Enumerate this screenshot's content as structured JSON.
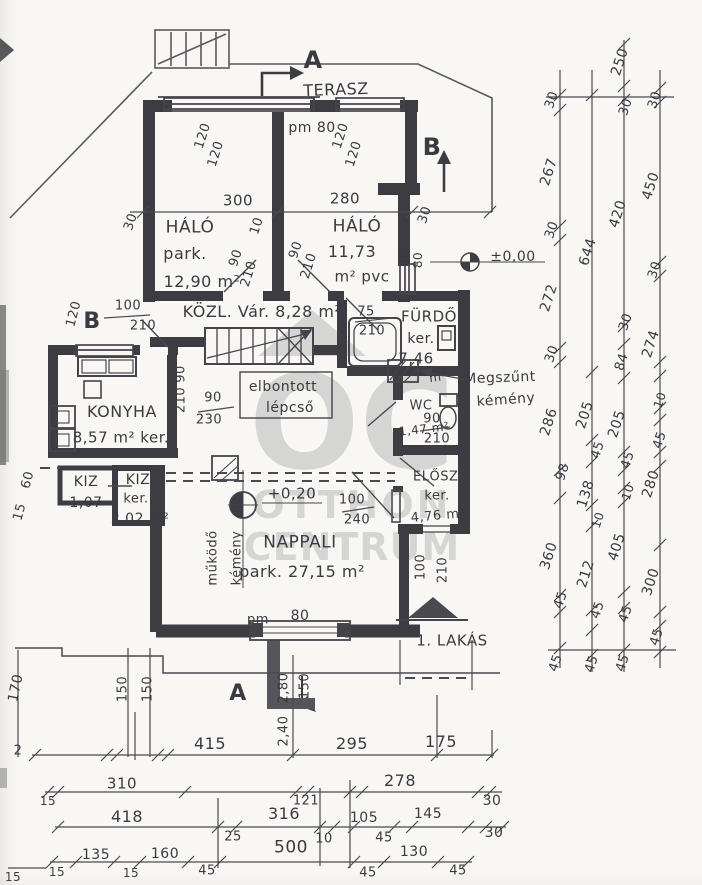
{
  "watermark": {
    "monogram": "OC",
    "line1": "OTTHON",
    "line2": "CENTRUM",
    "color": "#b4b4b4"
  },
  "plan": {
    "apartment_label": "1. LAKÁS",
    "rooms": [
      {
        "name": "TERASZ"
      },
      {
        "name": "HÁLÓ",
        "floor": "park.",
        "area": "12,90 m²"
      },
      {
        "name": "HÁLÓ",
        "area": "11,73",
        "floor": "m² pvc"
      },
      {
        "name": "KÖZL.",
        "note": "Vár.",
        "area": "8,28 m²"
      },
      {
        "name": "FÜRDŐ",
        "floor": "ker.",
        "area": "7,46 m²"
      },
      {
        "name": "KONYHA",
        "area": "8,57 m²",
        "floor": "ker."
      },
      {
        "name": "WC",
        "area": "1,47 m²"
      },
      {
        "name": "KIZ",
        "area": "1,07"
      },
      {
        "name": "KIZ",
        "floor": "ker.",
        "area": "2,02 m²"
      },
      {
        "name": "ELŐSZ.",
        "floor": "ker.",
        "area": "4,76 m²"
      },
      {
        "name": "NAPPALI",
        "floor": "park.",
        "area": "27,15 m²"
      }
    ],
    "notes": [
      "elbontott lépcső",
      "Megszűnt kémény",
      "működő kémény"
    ],
    "levels": [
      "±0,00",
      "+0,20"
    ],
    "section_markers": [
      "A",
      "B"
    ]
  },
  "labels": [
    {
      "t": "TERASZ",
      "x": 336,
      "y": 90,
      "s": 16,
      "r": -2,
      "n": "room-label-terasz"
    },
    {
      "t": "A",
      "x": 313,
      "y": 60,
      "s": 24,
      "b": 1,
      "n": "section-marker-a-top"
    },
    {
      "t": "pm 80",
      "x": 312,
      "y": 128,
      "s": 14
    },
    {
      "t": "120",
      "x": 203,
      "y": 136,
      "r": -72,
      "s": 13
    },
    {
      "t": "120",
      "x": 216,
      "y": 154,
      "r": -72,
      "s": 13
    },
    {
      "t": "120",
      "x": 341,
      "y": 136,
      "r": -72,
      "s": 13
    },
    {
      "t": "120",
      "x": 354,
      "y": 154,
      "r": -72,
      "s": 13
    },
    {
      "t": "B",
      "x": 432,
      "y": 147,
      "s": 24,
      "b": 1,
      "n": "section-marker-b-top"
    },
    {
      "t": "300",
      "x": 238,
      "y": 201,
      "s": 15
    },
    {
      "t": "280",
      "x": 345,
      "y": 199,
      "s": 15
    },
    {
      "t": "30",
      "x": 131,
      "y": 222,
      "r": -72,
      "s": 13
    },
    {
      "t": "10",
      "x": 257,
      "y": 226,
      "r": -72,
      "s": 13
    },
    {
      "t": "30",
      "x": 425,
      "y": 215,
      "r": -72,
      "s": 13
    },
    {
      "t": "HÁLÓ",
      "x": 190,
      "y": 228,
      "s": 17,
      "n": "room-label-halo-1"
    },
    {
      "t": "park.",
      "x": 185,
      "y": 254,
      "s": 16
    },
    {
      "t": "12,90 m²",
      "x": 202,
      "y": 282,
      "s": 16
    },
    {
      "t": "HÁLÓ",
      "x": 357,
      "y": 227,
      "s": 17,
      "n": "room-label-halo-2"
    },
    {
      "t": "11,73",
      "x": 352,
      "y": 252,
      "s": 16
    },
    {
      "t": "m² pvc",
      "x": 362,
      "y": 277,
      "s": 15
    },
    {
      "t": "90",
      "x": 236,
      "y": 258,
      "r": -72,
      "s": 13
    },
    {
      "t": "210",
      "x": 249,
      "y": 274,
      "r": -72,
      "s": 13
    },
    {
      "t": "90",
      "x": 296,
      "y": 250,
      "r": -72,
      "s": 13
    },
    {
      "t": "210",
      "x": 309,
      "y": 266,
      "r": -72,
      "s": 13
    },
    {
      "t": "60",
      "x": 404,
      "y": 258,
      "r": -90,
      "s": 12
    },
    {
      "t": "80",
      "x": 418,
      "y": 260,
      "r": -90,
      "s": 12
    },
    {
      "t": "±0,00",
      "x": 513,
      "y": 257,
      "s": 14,
      "n": "level-marker-zero"
    },
    {
      "t": "B",
      "x": 92,
      "y": 322,
      "s": 22,
      "b": 1,
      "n": "section-marker-b-left"
    },
    {
      "t": "120",
      "x": 74,
      "y": 314,
      "r": -75,
      "s": 13
    },
    {
      "t": "100",
      "x": 128,
      "y": 306,
      "s": 13
    },
    {
      "t": "210",
      "x": 143,
      "y": 326,
      "s": 13
    },
    {
      "t": "KÖZL. Vár. 8,28 m²",
      "x": 262,
      "y": 312,
      "s": 16,
      "n": "room-label-kozl"
    },
    {
      "t": "75",
      "x": 366,
      "y": 312,
      "s": 13
    },
    {
      "t": "210",
      "x": 372,
      "y": 331,
      "s": 13
    },
    {
      "t": "FÜRDŐ",
      "x": 429,
      "y": 317,
      "s": 15,
      "n": "room-label-furdo"
    },
    {
      "t": "ker.",
      "x": 421,
      "y": 339,
      "s": 14
    },
    {
      "t": "7,46",
      "x": 416,
      "y": 359,
      "s": 15
    },
    {
      "t": "m²",
      "x": 438,
      "y": 377,
      "s": 12,
      "r": -8
    },
    {
      "t": "Megszűnt",
      "x": 500,
      "y": 378,
      "s": 14,
      "r": -2,
      "n": "note-megszunt-kemeny"
    },
    {
      "t": "kémény",
      "x": 506,
      "y": 400,
      "s": 14,
      "r": -4
    },
    {
      "t": "90",
      "x": 181,
      "y": 374,
      "r": -90,
      "s": 13
    },
    {
      "t": "210",
      "x": 181,
      "y": 400,
      "r": -90,
      "s": 13
    },
    {
      "t": "elbontott",
      "x": 283,
      "y": 387,
      "s": 14,
      "n": "note-elbontott-lepcso"
    },
    {
      "t": "lépcső",
      "x": 290,
      "y": 408,
      "s": 14
    },
    {
      "t": "90",
      "x": 213,
      "y": 398,
      "s": 13
    },
    {
      "t": "230",
      "x": 209,
      "y": 420,
      "s": 13
    },
    {
      "t": "KONYHA",
      "x": 122,
      "y": 412,
      "s": 16,
      "n": "room-label-konyha"
    },
    {
      "t": "8,57 m² ker.",
      "x": 121,
      "y": 438,
      "s": 15
    },
    {
      "t": "WC",
      "x": 421,
      "y": 406,
      "s": 13,
      "n": "room-label-wc"
    },
    {
      "t": "1,47 m²",
      "x": 424,
      "y": 429,
      "s": 12,
      "r": -6
    },
    {
      "t": "90",
      "x": 432,
      "y": 419,
      "s": 13
    },
    {
      "t": "210",
      "x": 437,
      "y": 439,
      "s": 13
    },
    {
      "t": "60",
      "x": 28,
      "y": 480,
      "r": -75,
      "s": 13
    },
    {
      "t": "15",
      "x": 20,
      "y": 512,
      "r": -75,
      "s": 13
    },
    {
      "t": "KIZ",
      "x": 86,
      "y": 482,
      "s": 14,
      "n": "room-label-kiz-1"
    },
    {
      "t": "1,07",
      "x": 86,
      "y": 503,
      "s": 14
    },
    {
      "t": "KIZ",
      "x": 138,
      "y": 480,
      "s": 14,
      "n": "room-label-kiz-2"
    },
    {
      "t": "ker.",
      "x": 136,
      "y": 499,
      "s": 13
    },
    {
      "t": "2,02 m²",
      "x": 140,
      "y": 519,
      "s": 14
    },
    {
      "t": "ELŐSZ.",
      "x": 438,
      "y": 477,
      "s": 13,
      "n": "room-label-elosz"
    },
    {
      "t": "ker.",
      "x": 437,
      "y": 496,
      "s": 13
    },
    {
      "t": "4,76 m²",
      "x": 438,
      "y": 516,
      "s": 13,
      "r": -5
    },
    {
      "t": "+0,20",
      "x": 292,
      "y": 494,
      "s": 15,
      "n": "level-marker-plus020"
    },
    {
      "t": "100",
      "x": 352,
      "y": 500,
      "s": 13
    },
    {
      "t": "240",
      "x": 357,
      "y": 520,
      "s": 13
    },
    {
      "t": "NAPPALI",
      "x": 300,
      "y": 543,
      "s": 17,
      "n": "room-label-nappali"
    },
    {
      "t": "park. 27,15 m²",
      "x": 302,
      "y": 572,
      "s": 16
    },
    {
      "t": "működő",
      "x": 213,
      "y": 558,
      "r": -90,
      "s": 13,
      "n": "note-mukodo-kemeny"
    },
    {
      "t": "kémény",
      "x": 237,
      "y": 558,
      "r": -90,
      "s": 13
    },
    {
      "t": "100",
      "x": 421,
      "y": 567,
      "r": -90,
      "s": 13
    },
    {
      "t": "210",
      "x": 443,
      "y": 570,
      "r": -90,
      "s": 13
    },
    {
      "t": "1. LAKÁS",
      "x": 452,
      "y": 641,
      "s": 15,
      "n": "apartment-label"
    },
    {
      "t": "pm",
      "x": 258,
      "y": 620,
      "s": 13
    },
    {
      "t": "80",
      "x": 300,
      "y": 616,
      "s": 14
    },
    {
      "t": "A",
      "x": 238,
      "y": 694,
      "s": 22,
      "b": 1,
      "n": "section-marker-a-bottom"
    },
    {
      "t": "2,80",
      "x": 284,
      "y": 688,
      "r": -90,
      "s": 13
    },
    {
      "t": "150",
      "x": 305,
      "y": 686,
      "r": -90,
      "s": 13
    },
    {
      "t": "2,40",
      "x": 284,
      "y": 731,
      "r": -90,
      "s": 13
    },
    {
      "t": "170",
      "x": 16,
      "y": 688,
      "r": -78,
      "s": 14
    },
    {
      "t": "150",
      "x": 123,
      "y": 689,
      "r": -90,
      "s": 13
    },
    {
      "t": "150",
      "x": 148,
      "y": 689,
      "r": -90,
      "s": 13
    },
    {
      "t": "2",
      "x": 18,
      "y": 751,
      "s": 13
    },
    {
      "t": "415",
      "x": 210,
      "y": 744,
      "s": 16
    },
    {
      "t": "295",
      "x": 352,
      "y": 744,
      "s": 16
    },
    {
      "t": "175",
      "x": 441,
      "y": 742,
      "s": 16
    },
    {
      "t": "15",
      "x": 48,
      "y": 801,
      "s": 12
    },
    {
      "t": "310",
      "x": 122,
      "y": 784,
      "s": 15
    },
    {
      "t": "121",
      "x": 306,
      "y": 801,
      "s": 13
    },
    {
      "t": "278",
      "x": 400,
      "y": 781,
      "s": 16
    },
    {
      "t": "30",
      "x": 492,
      "y": 801,
      "s": 14
    },
    {
      "t": "418",
      "x": 127,
      "y": 817,
      "s": 16
    },
    {
      "t": "25",
      "x": 233,
      "y": 837,
      "s": 13
    },
    {
      "t": "316",
      "x": 284,
      "y": 814,
      "s": 16
    },
    {
      "t": "10",
      "x": 324,
      "y": 839,
      "s": 13
    },
    {
      "t": "105",
      "x": 364,
      "y": 818,
      "s": 14
    },
    {
      "t": "45",
      "x": 384,
      "y": 838,
      "s": 13
    },
    {
      "t": "145",
      "x": 428,
      "y": 814,
      "s": 14
    },
    {
      "t": "30",
      "x": 494,
      "y": 833,
      "s": 14
    },
    {
      "t": "15",
      "x": 57,
      "y": 872,
      "s": 12
    },
    {
      "t": "135",
      "x": 96,
      "y": 855,
      "s": 14
    },
    {
      "t": "15",
      "x": 131,
      "y": 873,
      "s": 12
    },
    {
      "t": "160",
      "x": 165,
      "y": 854,
      "s": 14
    },
    {
      "t": "45",
      "x": 207,
      "y": 871,
      "s": 13
    },
    {
      "t": "500",
      "x": 291,
      "y": 848,
      "s": 17
    },
    {
      "t": "45",
      "x": 368,
      "y": 873,
      "s": 13
    },
    {
      "t": "130",
      "x": 414,
      "y": 852,
      "s": 14
    },
    {
      "t": "45",
      "x": 458,
      "y": 871,
      "s": 13
    },
    {
      "t": "15",
      "x": 13,
      "y": 877,
      "s": 12
    },
    {
      "t": "30",
      "x": 552,
      "y": 100,
      "r": -72,
      "s": 13
    },
    {
      "t": "267",
      "x": 549,
      "y": 172,
      "r": -72,
      "s": 14
    },
    {
      "t": "30",
      "x": 552,
      "y": 230,
      "r": -72,
      "s": 13
    },
    {
      "t": "272",
      "x": 549,
      "y": 298,
      "r": -72,
      "s": 14
    },
    {
      "t": "30",
      "x": 552,
      "y": 354,
      "r": -72,
      "s": 13
    },
    {
      "t": "286",
      "x": 549,
      "y": 422,
      "r": -72,
      "s": 14
    },
    {
      "t": "98",
      "x": 563,
      "y": 472,
      "r": -72,
      "s": 13
    },
    {
      "t": "360",
      "x": 549,
      "y": 556,
      "r": -72,
      "s": 14
    },
    {
      "t": "45",
      "x": 561,
      "y": 600,
      "r": -72,
      "s": 13
    },
    {
      "t": "45",
      "x": 556,
      "y": 663,
      "r": -72,
      "s": 13
    },
    {
      "t": "644",
      "x": 588,
      "y": 252,
      "r": -72,
      "s": 14
    },
    {
      "t": "205",
      "x": 585,
      "y": 415,
      "r": -72,
      "s": 14
    },
    {
      "t": "45",
      "x": 598,
      "y": 450,
      "r": -72,
      "s": 13
    },
    {
      "t": "138",
      "x": 586,
      "y": 494,
      "r": -72,
      "s": 14
    },
    {
      "t": "10",
      "x": 598,
      "y": 520,
      "r": -72,
      "s": 12
    },
    {
      "t": "212",
      "x": 586,
      "y": 574,
      "r": -72,
      "s": 14
    },
    {
      "t": "45",
      "x": 598,
      "y": 610,
      "r": -72,
      "s": 13
    },
    {
      "t": "45",
      "x": 592,
      "y": 664,
      "r": -72,
      "s": 13
    },
    {
      "t": "250",
      "x": 620,
      "y": 62,
      "r": -72,
      "s": 14
    },
    {
      "t": "30",
      "x": 626,
      "y": 107,
      "r": -72,
      "s": 13
    },
    {
      "t": "420",
      "x": 618,
      "y": 214,
      "r": -72,
      "s": 14
    },
    {
      "t": "30",
      "x": 626,
      "y": 322,
      "r": -72,
      "s": 13
    },
    {
      "t": "84",
      "x": 622,
      "y": 362,
      "r": -72,
      "s": 13
    },
    {
      "t": "205",
      "x": 617,
      "y": 424,
      "r": -72,
      "s": 14
    },
    {
      "t": "45",
      "x": 628,
      "y": 460,
      "r": -72,
      "s": 13
    },
    {
      "t": "10",
      "x": 628,
      "y": 492,
      "r": -72,
      "s": 12
    },
    {
      "t": "405",
      "x": 617,
      "y": 547,
      "r": -72,
      "s": 14
    },
    {
      "t": "45",
      "x": 626,
      "y": 614,
      "r": -72,
      "s": 13
    },
    {
      "t": "45",
      "x": 623,
      "y": 663,
      "r": -72,
      "s": 13
    },
    {
      "t": "30",
      "x": 655,
      "y": 100,
      "r": -72,
      "s": 13
    },
    {
      "t": "450",
      "x": 651,
      "y": 186,
      "r": -72,
      "s": 14
    },
    {
      "t": "30",
      "x": 655,
      "y": 270,
      "r": -72,
      "s": 13
    },
    {
      "t": "274",
      "x": 651,
      "y": 344,
      "r": -72,
      "s": 14
    },
    {
      "t": "10",
      "x": 660,
      "y": 400,
      "r": -72,
      "s": 12
    },
    {
      "t": "45",
      "x": 660,
      "y": 440,
      "r": -72,
      "s": 13
    },
    {
      "t": "280",
      "x": 651,
      "y": 484,
      "r": -72,
      "s": 14
    },
    {
      "t": "300",
      "x": 651,
      "y": 582,
      "r": -72,
      "s": 14
    },
    {
      "t": "45",
      "x": 657,
      "y": 637,
      "r": -72,
      "s": 13
    }
  ]
}
